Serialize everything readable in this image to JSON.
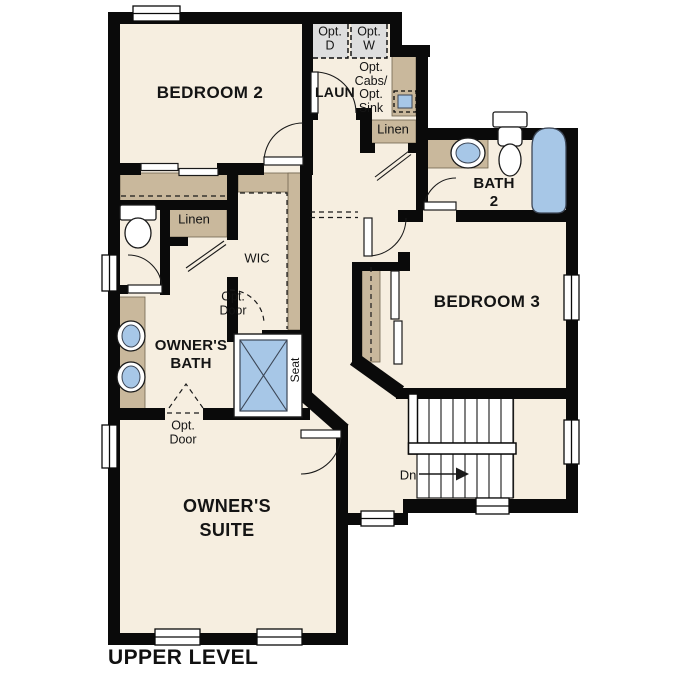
{
  "title": "UPPER LEVEL",
  "rooms": {
    "bedroom2": "BEDROOM 2",
    "bedroom3": "BEDROOM 3",
    "owners_suite": [
      "OWNER'S",
      "SUITE"
    ],
    "owners_bath": [
      "OWNER'S",
      "BATH"
    ],
    "bath2": [
      "BATH",
      "2"
    ],
    "laundry": "LAUN",
    "wic": "WIC"
  },
  "closets": {
    "linen_bath": "Linen",
    "linen_hall": "Linen"
  },
  "annotations": {
    "opt_dryer": [
      "Opt.",
      "D"
    ],
    "opt_washer": [
      "Opt.",
      "W"
    ],
    "opt_cabs_sink": [
      "Opt.",
      "Cabs/",
      "Opt.",
      "Sink"
    ],
    "opt_door_wic": [
      "Opt.",
      "Door"
    ],
    "opt_door_bath": [
      "Opt.",
      "Door"
    ],
    "stairs_direction": "Dn",
    "shower_seat": "Seat"
  },
  "colors": {
    "floor": "#f6eee0",
    "wall": "#0a0a0a",
    "cabinet": "#c9b89c",
    "cabinet_edge": "#70654f",
    "fixture": "#a7c7e7",
    "fixture_edge": "#3c4656",
    "appliance": "#dedede",
    "line": "#1a1a1a"
  }
}
